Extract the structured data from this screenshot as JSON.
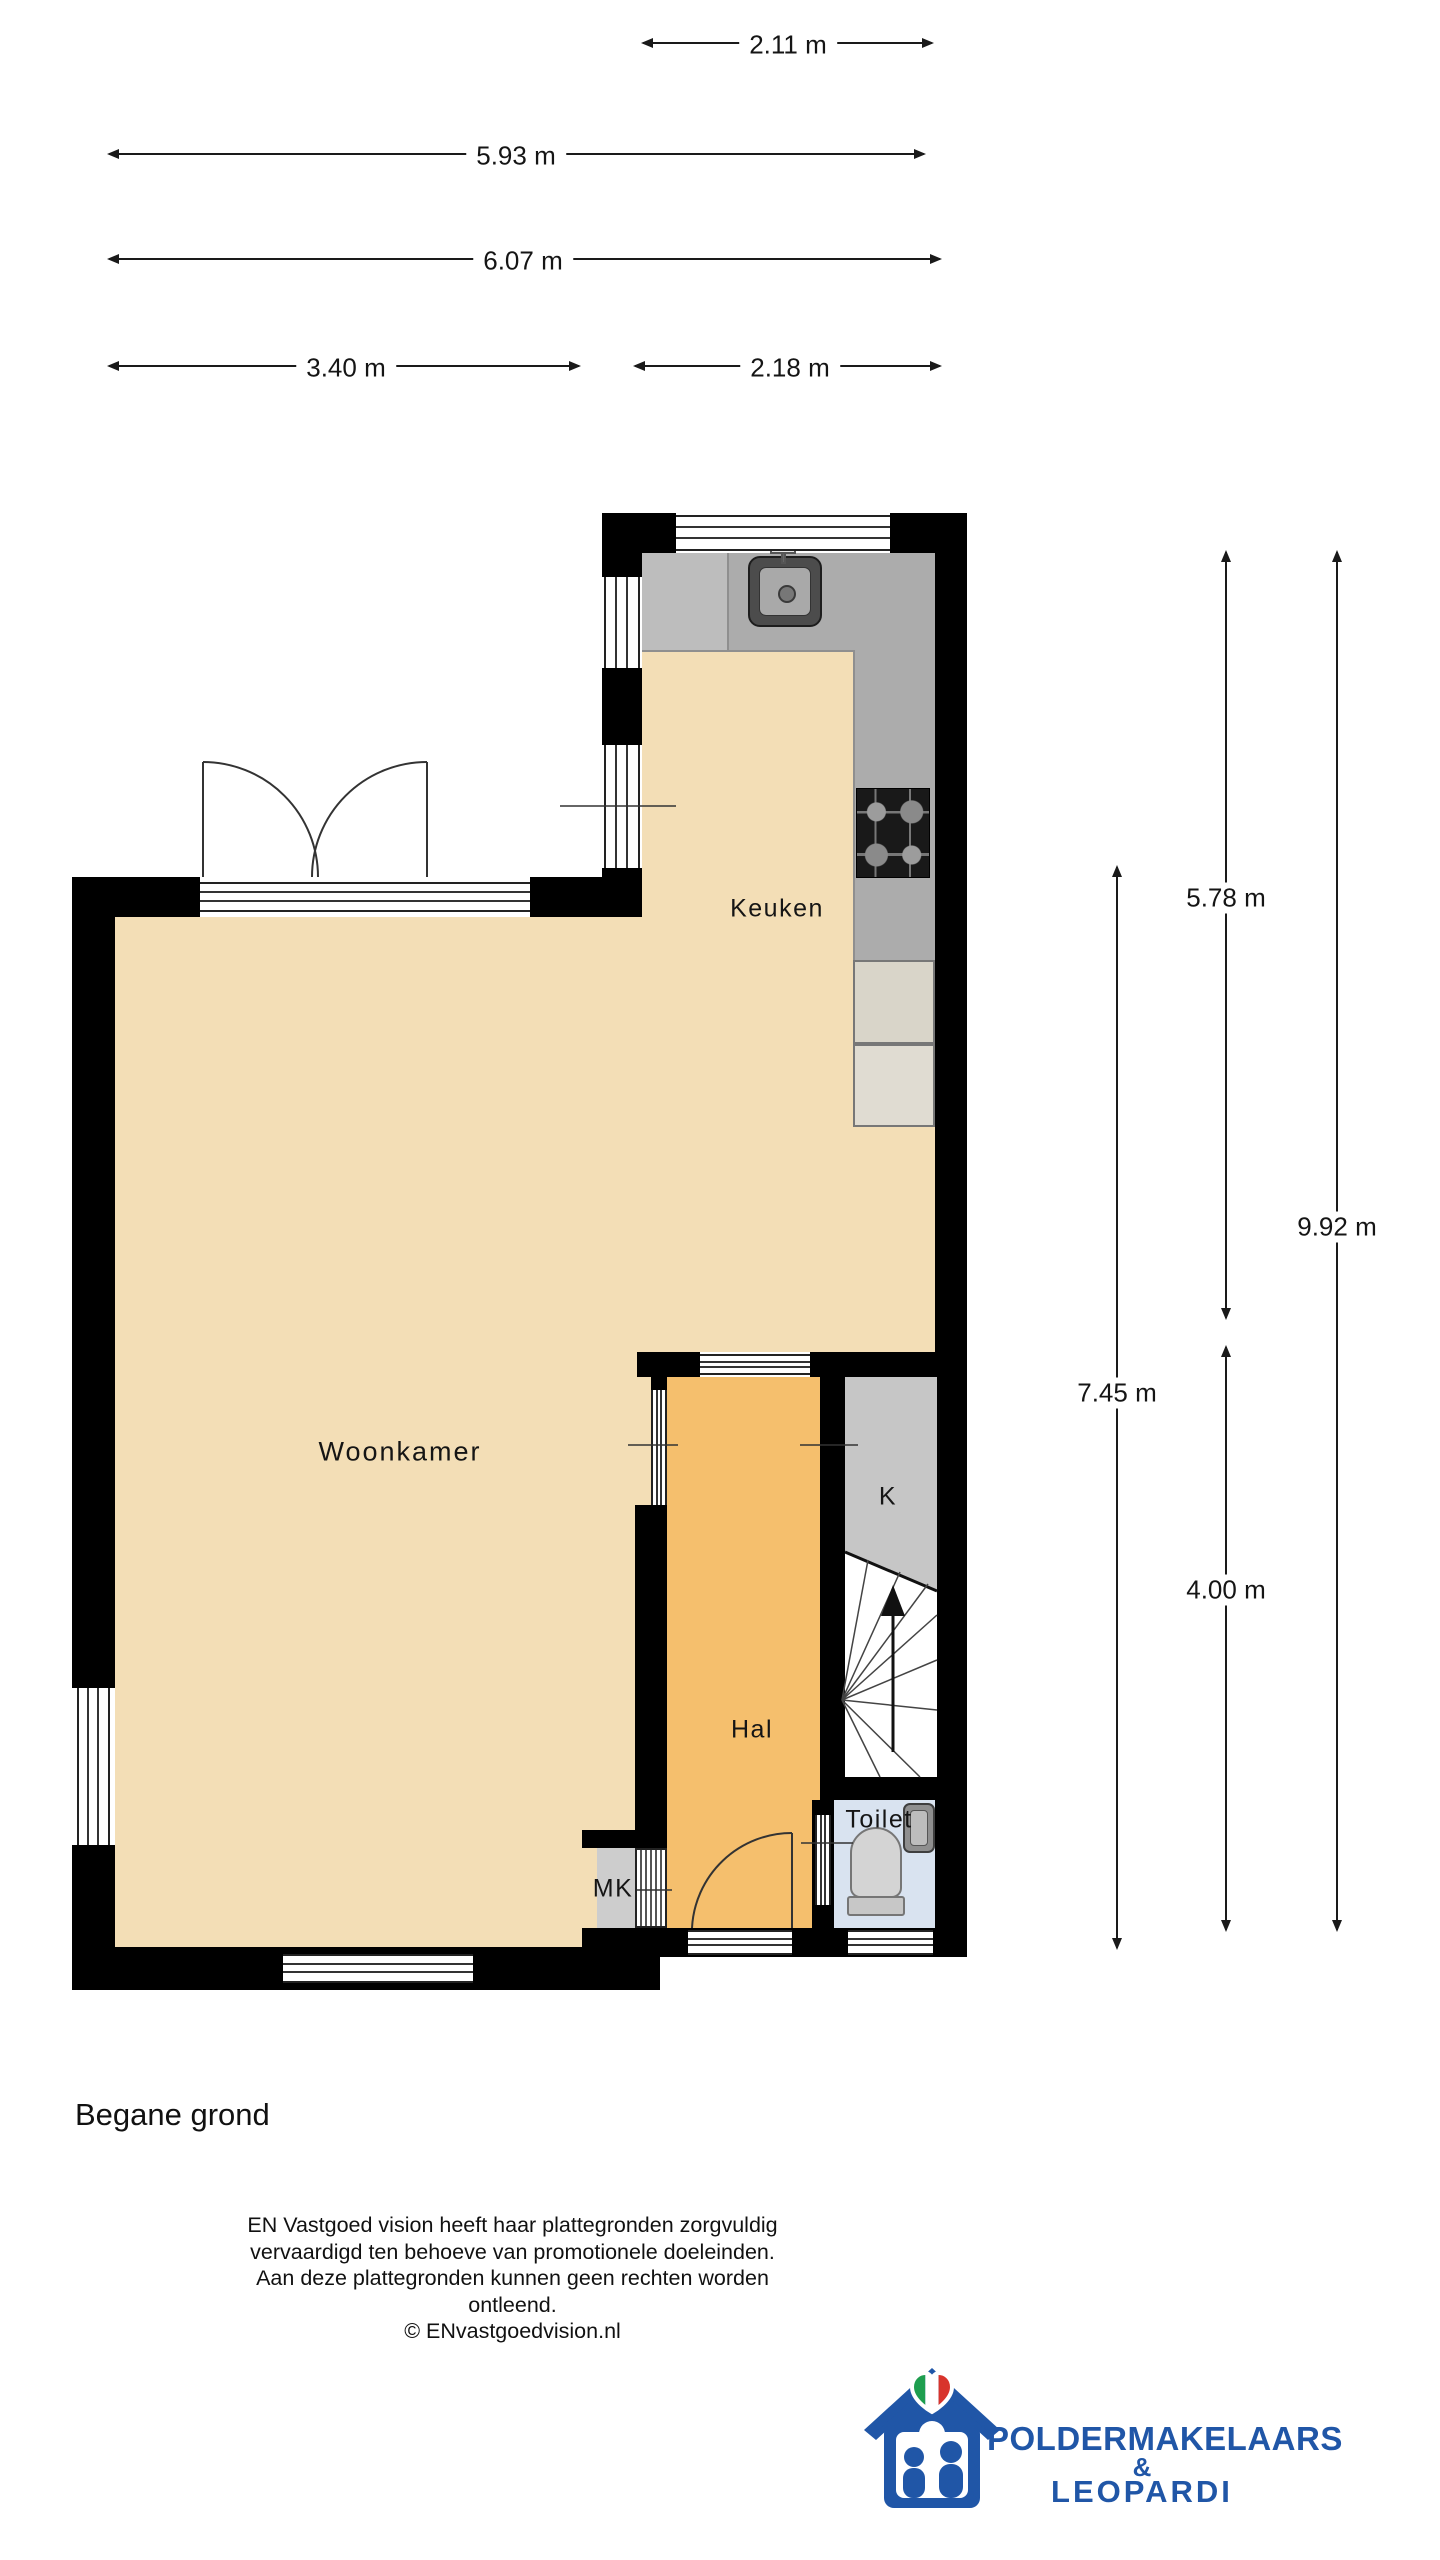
{
  "page": {
    "title": "Begane grond"
  },
  "rooms": {
    "woonkamer": "Woonkamer",
    "keuken": "Keuken",
    "hal": "Hal",
    "toilet": "Toilet",
    "kast": "K",
    "meterkast": "MK"
  },
  "dimensions": {
    "top": [
      "2.11 m",
      "5.93 m",
      "6.07 m",
      "3.40 m",
      "2.18 m"
    ],
    "right": [
      "5.78 m",
      "9.92 m",
      "7.45 m",
      "4.00 m"
    ]
  },
  "stairs": {
    "direction_icon": "arrow-up"
  },
  "disclaimer": {
    "line1": "EN Vastgoed vision heeft haar plattegronden zorgvuldig",
    "line2": "vervaardigd ten behoeve van promotionele doeleinden.",
    "line3": "Aan deze plattegronden kunnen geen rechten worden ontleend.",
    "line4": "© ENvastgoedvision.nl"
  },
  "logo": {
    "name_top": "POLDERMAKELAARS",
    "amp": "&",
    "name_bottom": "LEOPARDI",
    "icon": "house-with-heart-and-family-icon"
  },
  "colors": {
    "wall": "#000000",
    "floor_living": "#F3DEB6",
    "floor_hall": "#F5BF6D",
    "floor_toilet": "#D9E3F0",
    "closet": "#C6C6C6",
    "counter": "#ACACAC",
    "counter_light": "#BDBDBD",
    "appliance_a": "#D9D5C9",
    "appliance_b": "#E0DCD2",
    "mk": "#CDCDCD",
    "logo_blue": "#2056A7",
    "flag_green": "#1E9E4F",
    "flag_red": "#D8342C"
  }
}
